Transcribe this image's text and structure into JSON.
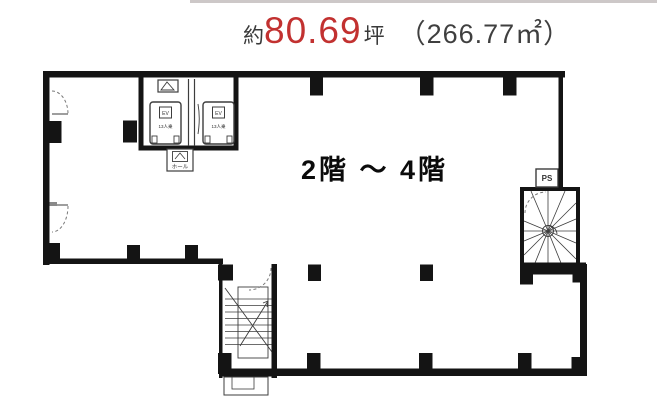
{
  "header": {
    "approx_prefix": "約",
    "area_tsubo_value": "80.69",
    "tsubo_unit": "坪",
    "area_sqm": "（266.77㎡）",
    "accent_color": "#c23130"
  },
  "floorplan": {
    "floor_range_label": "2階 〜 4階",
    "ps_label": "PS",
    "ev_label": "EV",
    "ev_capacity_label": "13人乗",
    "ev_hall_label": "ホール",
    "wall_color": "#141414"
  }
}
